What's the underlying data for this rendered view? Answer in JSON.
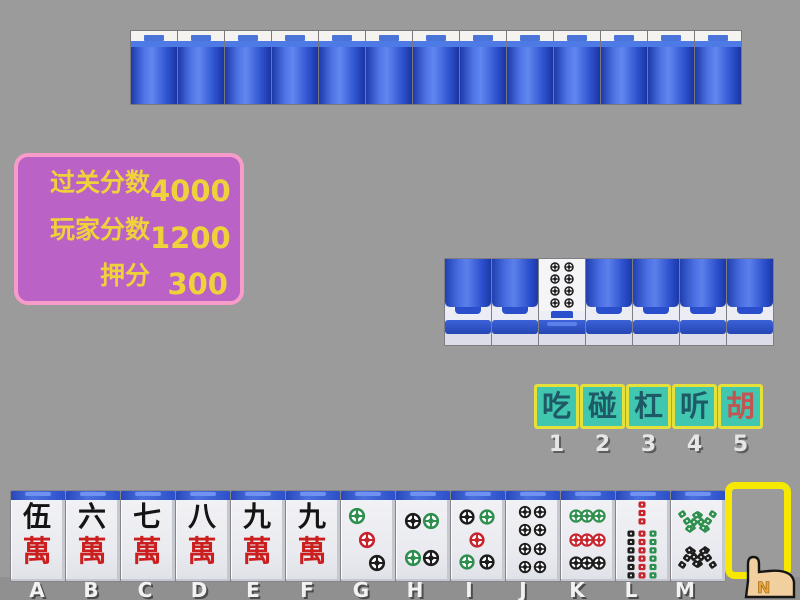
{
  "window": {
    "bg_color": "#9b9b9b"
  },
  "score_panel": {
    "bg_color": "#bb62c6",
    "border_color": "#f79cc8",
    "text_color": "#efd23b",
    "rows": [
      {
        "label": "过关分数",
        "value": "4000"
      },
      {
        "label": "玩家分数",
        "value": "1200"
      },
      {
        "label": "押分",
        "value": "300"
      }
    ]
  },
  "opponent_row": {
    "tile_count": 13
  },
  "meld_row": {
    "tiles": [
      {
        "face": "back"
      },
      {
        "face": "back"
      },
      {
        "face": "up",
        "suit": "dots",
        "value": 8
      },
      {
        "face": "back"
      },
      {
        "face": "back"
      },
      {
        "face": "back"
      },
      {
        "face": "back"
      }
    ]
  },
  "action_buttons": {
    "bg_color": "#41c6b0",
    "border_color": "#e5e03a",
    "items": [
      {
        "label": "吃",
        "hotkey": "1",
        "text_color": "#1e5a66"
      },
      {
        "label": "碰",
        "hotkey": "2",
        "text_color": "#1e5a66"
      },
      {
        "label": "杠",
        "hotkey": "3",
        "text_color": "#1e5a66"
      },
      {
        "label": "听",
        "hotkey": "4",
        "text_color": "#1e5a66"
      },
      {
        "label": "胡",
        "hotkey": "5",
        "text_color": "#c25452"
      }
    ]
  },
  "player_hand": {
    "slots": [
      {
        "key": "A",
        "suit": "wan",
        "num_char": "伍",
        "suit_char": "萬"
      },
      {
        "key": "B",
        "suit": "wan",
        "num_char": "六",
        "suit_char": "萬"
      },
      {
        "key": "C",
        "suit": "wan",
        "num_char": "七",
        "suit_char": "萬"
      },
      {
        "key": "D",
        "suit": "wan",
        "num_char": "八",
        "suit_char": "萬"
      },
      {
        "key": "E",
        "suit": "wan",
        "num_char": "九",
        "suit_char": "萬"
      },
      {
        "key": "F",
        "suit": "wan",
        "num_char": "九",
        "suit_char": "萬"
      },
      {
        "key": "G",
        "suit": "dots",
        "value": 3
      },
      {
        "key": "H",
        "suit": "dots",
        "value": 4
      },
      {
        "key": "I",
        "suit": "dots",
        "value": 5
      },
      {
        "key": "J",
        "suit": "dots",
        "value": 8
      },
      {
        "key": "K",
        "suit": "dots",
        "value": 9
      },
      {
        "key": "L",
        "suit": "bamboo",
        "value": 7
      },
      {
        "key": "M",
        "suit": "bamboo",
        "value": 8
      }
    ]
  },
  "pip_colors": {
    "g": "#2f8f4e",
    "r": "#c8242e",
    "k": "#1d1d1d"
  },
  "tile_layouts": {
    "dots": {
      "3": [
        [
          30,
          20,
          "g"
        ],
        [
          50,
          50,
          "r"
        ],
        [
          70,
          80,
          "k"
        ]
      ],
      "4": [
        [
          32,
          27,
          "k"
        ],
        [
          68,
          27,
          "g"
        ],
        [
          32,
          73,
          "g"
        ],
        [
          68,
          73,
          "k"
        ]
      ],
      "5": [
        [
          30,
          22,
          "k"
        ],
        [
          70,
          22,
          "g"
        ],
        [
          50,
          50,
          "r"
        ],
        [
          30,
          78,
          "g"
        ],
        [
          70,
          78,
          "k"
        ]
      ],
      "8": [
        [
          35,
          15,
          "k"
        ],
        [
          65,
          15,
          "k"
        ],
        [
          35,
          38,
          "k"
        ],
        [
          65,
          38,
          "k"
        ],
        [
          35,
          62,
          "k"
        ],
        [
          65,
          62,
          "k"
        ],
        [
          35,
          85,
          "k"
        ],
        [
          65,
          85,
          "k"
        ]
      ],
      "9": [
        [
          27,
          20,
          "g"
        ],
        [
          50,
          20,
          "g"
        ],
        [
          73,
          20,
          "g"
        ],
        [
          27,
          50,
          "r"
        ],
        [
          50,
          50,
          "r"
        ],
        [
          73,
          50,
          "r"
        ],
        [
          27,
          80,
          "k"
        ],
        [
          50,
          80,
          "k"
        ],
        [
          73,
          80,
          "k"
        ]
      ]
    },
    "bamboo": {
      "7": [
        [
          50,
          16,
          "r",
          0
        ],
        [
          28,
          53,
          "k",
          0
        ],
        [
          50,
          53,
          "r",
          0
        ],
        [
          72,
          53,
          "g",
          0
        ],
        [
          28,
          85,
          "k",
          0
        ],
        [
          50,
          85,
          "r",
          0
        ],
        [
          72,
          85,
          "g",
          0
        ]
      ],
      "8": [
        [
          30,
          26,
          "g",
          -35
        ],
        [
          44,
          28,
          "g",
          35
        ],
        [
          58,
          28,
          "g",
          -35
        ],
        [
          72,
          26,
          "g",
          35
        ],
        [
          30,
          74,
          "k",
          35
        ],
        [
          44,
          72,
          "k",
          -35
        ],
        [
          58,
          72,
          "k",
          35
        ],
        [
          72,
          74,
          "k",
          -35
        ]
      ]
    }
  },
  "selection_box": {
    "border_color": "#f6e800"
  },
  "cursor": {
    "label": "N"
  }
}
